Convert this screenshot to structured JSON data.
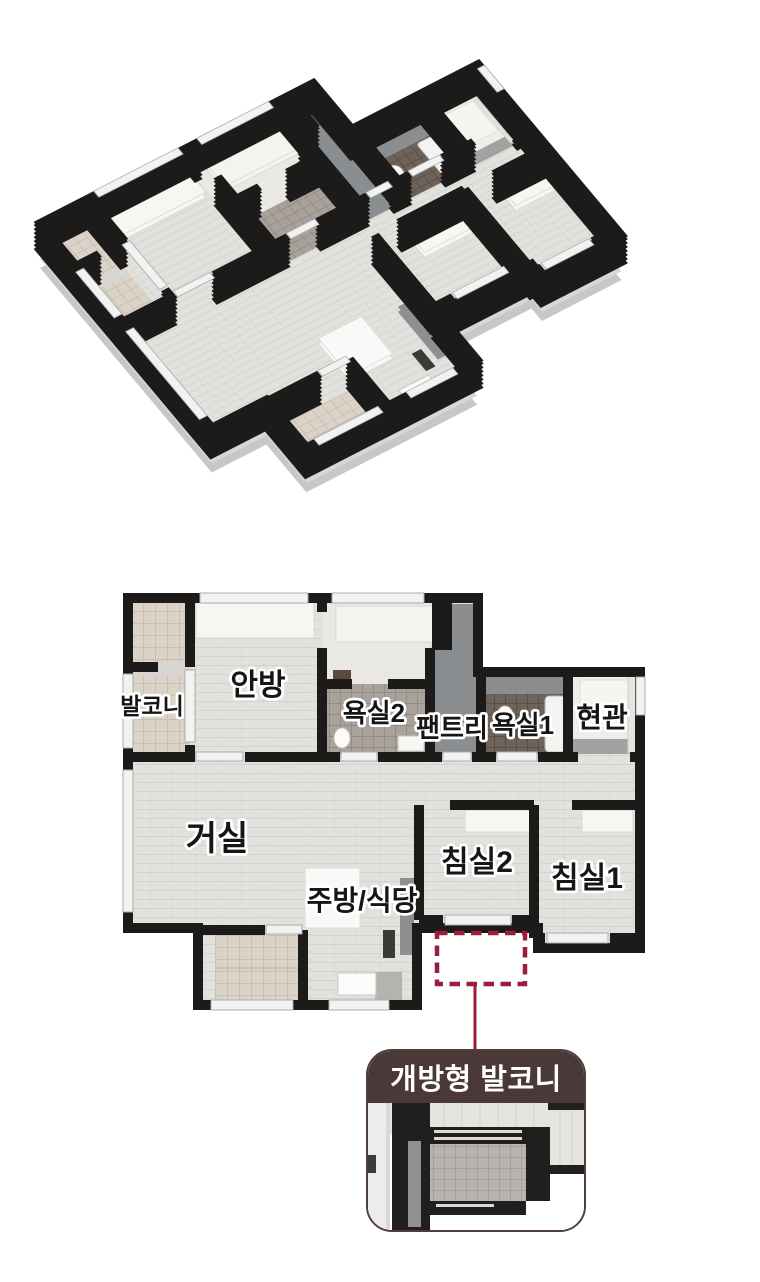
{
  "views": {
    "top_label": "3D isometric apartment view",
    "bottom_label": "2D floor plan"
  },
  "floorplan": {
    "rooms": [
      {
        "id": "balcony",
        "label": "발코니"
      },
      {
        "id": "master-bedroom",
        "label": "안방"
      },
      {
        "id": "bathroom-2",
        "label": "욕실2"
      },
      {
        "id": "pantry",
        "label": "팬트리"
      },
      {
        "id": "bathroom-1",
        "label": "욕실1"
      },
      {
        "id": "entrance",
        "label": "현관"
      },
      {
        "id": "living-room",
        "label": "거실"
      },
      {
        "id": "kitchen-dining",
        "label": "주방/식당"
      },
      {
        "id": "bedroom-2",
        "label": "침실2"
      },
      {
        "id": "bedroom-1",
        "label": "침실1"
      }
    ]
  },
  "callout": {
    "label": "개방형 발코니"
  },
  "colors": {
    "accent_crimson": "#9e1b3a",
    "callout_header_brown": "#4a3938",
    "wall_black": "#1c1b1a",
    "floor_light": "#e1e2de",
    "balcony_tile_beige": "#dbd3c8",
    "bathroom1_tile_brown": "#6f6258",
    "bathroom2_tile_gray": "#a9a29b",
    "pantry_gray": "#8b8e90"
  }
}
